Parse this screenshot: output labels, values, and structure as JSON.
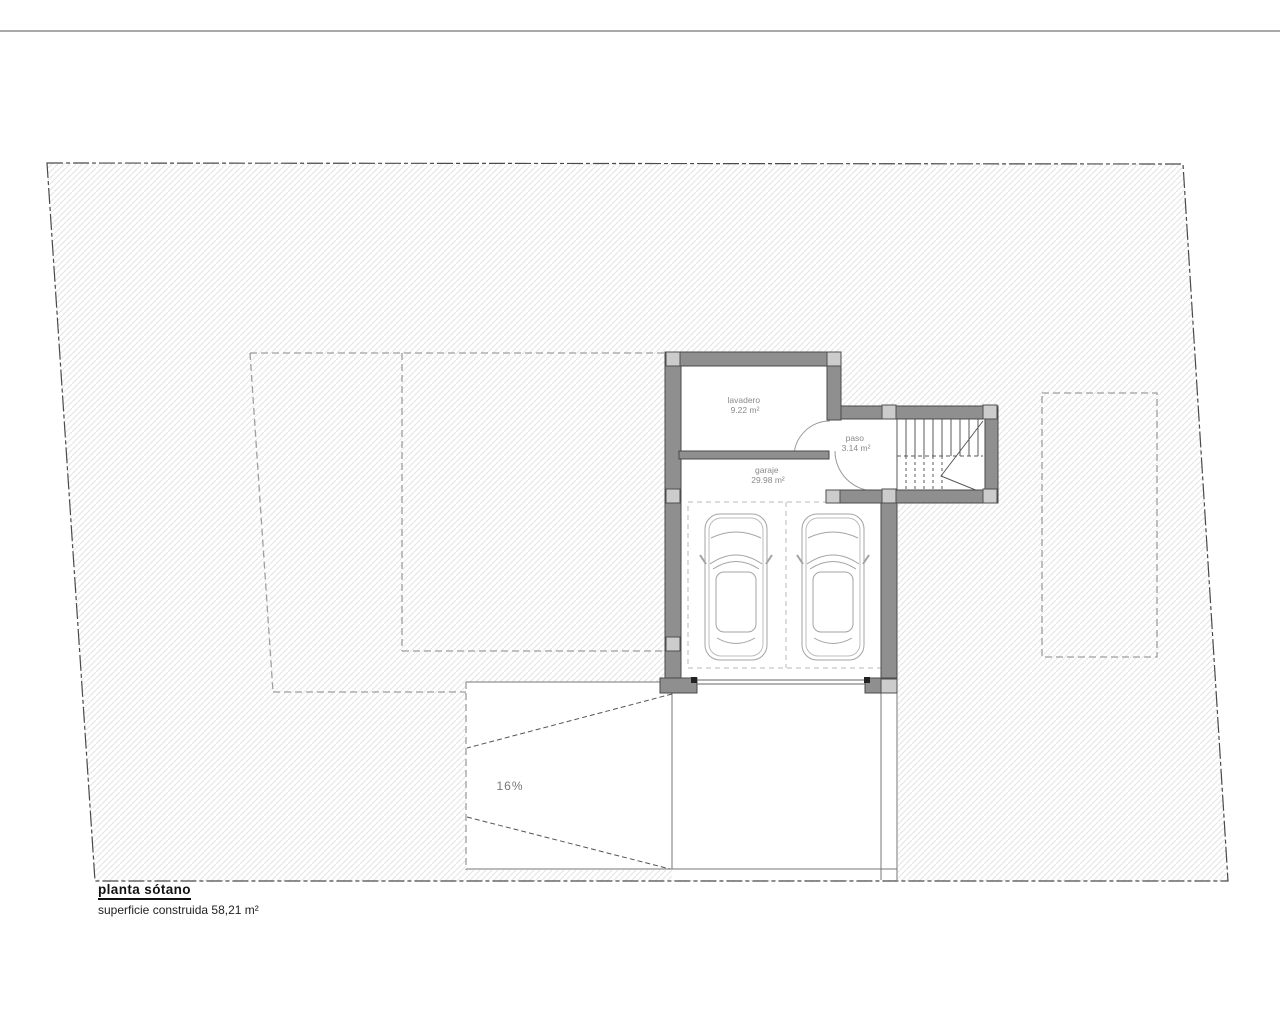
{
  "drawing": {
    "title": "planta sótano",
    "subtitle": "superficie construida 58,21 m²",
    "rooms": [
      {
        "name": "lavadero",
        "area": "9.22 m²"
      },
      {
        "name": "paso",
        "area": "3.14 m²"
      },
      {
        "name": "garaje",
        "area": "29.98 m²"
      }
    ],
    "ramp": {
      "slope_label": "16%"
    },
    "colors": {
      "wall": "#8f8f8f",
      "pillar": "#cccccc",
      "hatch_line": "#e2e2e2",
      "dashed_line": "#9f9f9f",
      "boundary": "#4a4a4a",
      "label_text": "#8a8a8a",
      "title_text": "#111111"
    }
  }
}
